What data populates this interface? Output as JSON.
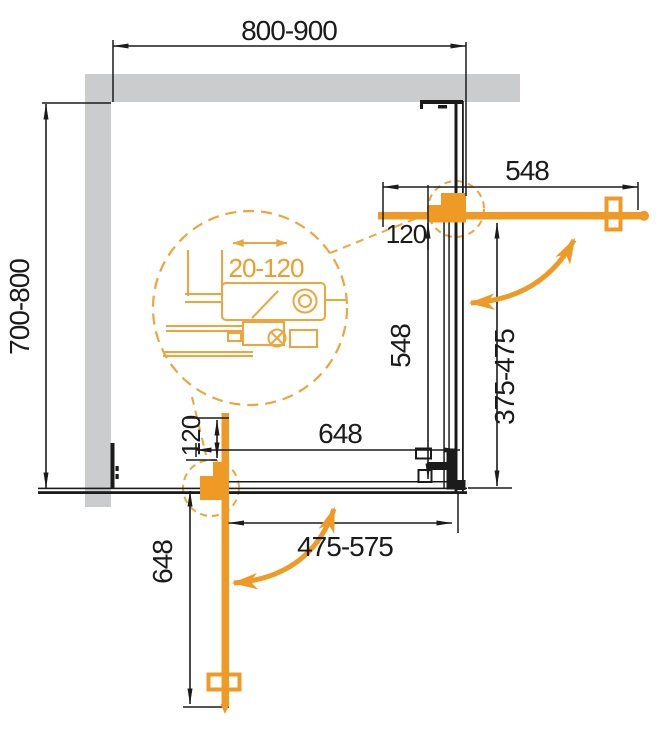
{
  "diagram": {
    "title": "corner-shower-enclosure-plan-drawing",
    "colors": {
      "accent": "#F09A26",
      "wall_gray": "#CACCCE",
      "line_black": "#1B1B1B"
    },
    "dims": {
      "width": "800-900",
      "depth": "700-800",
      "door_top_length": "548",
      "door_top_offset": "120",
      "side_fixed_length": "548",
      "side_opening": "375-475",
      "bottom_fixed_length": "648",
      "door_left_offset": "120",
      "door_left_length": "648",
      "bottom_opening": "475-575",
      "profile_adjustment": "20-120"
    }
  }
}
